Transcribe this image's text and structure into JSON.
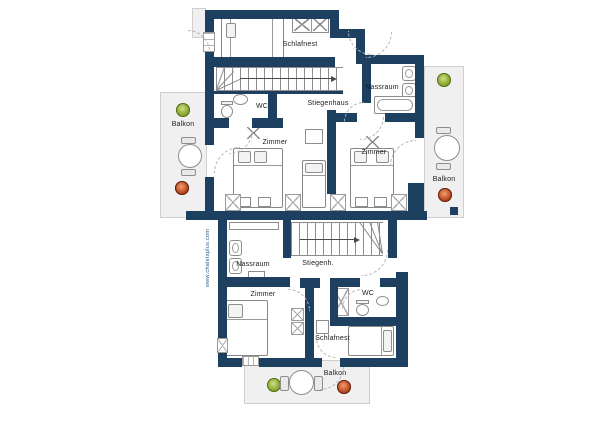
{
  "upper": {
    "schlafnest": "Schlafnest",
    "wc": "WC",
    "stiegenhaus": "Stiegenhaus",
    "nassraum": "Nassraum",
    "zimmer_left": "Zimmer",
    "zimmer_right": "Zimmer",
    "balkon_left": "Balkon",
    "balkon_right": "Balkon"
  },
  "lower": {
    "nassraum": "Nassraum",
    "stiegenhaus": "Stiegenh.",
    "zimmer": "Zimmer",
    "wc": "WC",
    "schlafnest": "Schlafnest",
    "balkon": "Balkon"
  },
  "watermark": "www.chaletsplus.com",
  "colors": {
    "wall": "#1d4061",
    "outside": "#f0f0f0",
    "furniture_stroke": "#8d8d8d",
    "plant_green": "#8fae3a",
    "plant_red": "#c0492b",
    "label": "#1b1b1b"
  }
}
